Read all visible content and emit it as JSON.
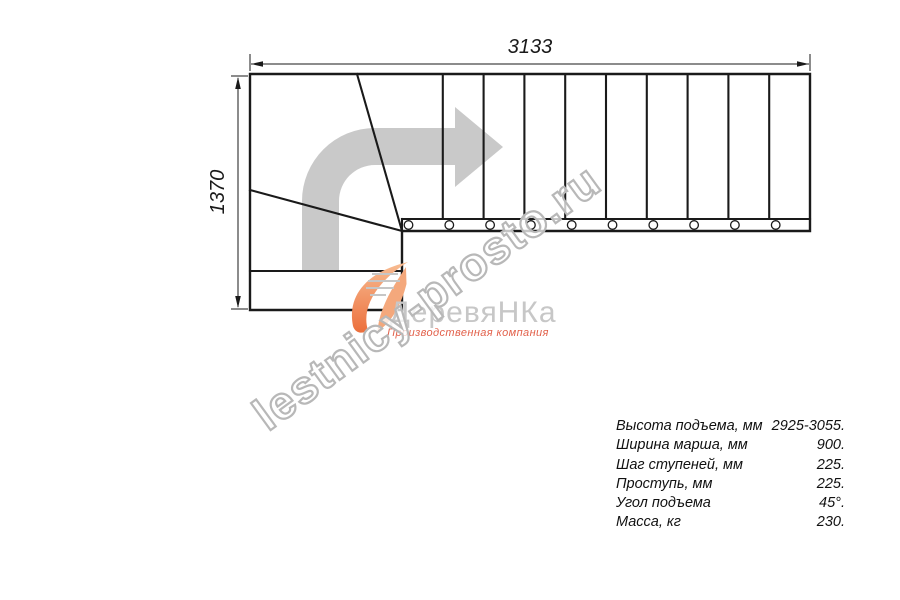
{
  "drawing": {
    "type": "staircase-plan-top-view",
    "width_label": "3133",
    "height_label": "1370",
    "straight_treads": 10,
    "winder_treads": 3
  },
  "watermark": {
    "text": "lestnicy-prosto.ru"
  },
  "logo": {
    "brand": "ДеревяНКа",
    "subtitle": "Производственная компания"
  },
  "specs": {
    "rows": [
      {
        "label": "Высота подъема, мм",
        "value": "2925-3055."
      },
      {
        "label": "Ширина марша, мм",
        "value": "900."
      },
      {
        "label": "Шаг ступеней, мм",
        "value": "225."
      },
      {
        "label": "Проступь, мм",
        "value": "225."
      },
      {
        "label": "Угол подъема",
        "value": "45°."
      },
      {
        "label": "Масса, кг",
        "value": "230."
      }
    ]
  },
  "colors": {
    "line": "#1a1a1a",
    "direction_arrow": "#c9c9c9",
    "logo_gray": "#c7c7c7",
    "logo_orange": "#ec6f3c",
    "subtitle_orange": "#e2604a",
    "watermark_outline": "#b8b8b8"
  }
}
